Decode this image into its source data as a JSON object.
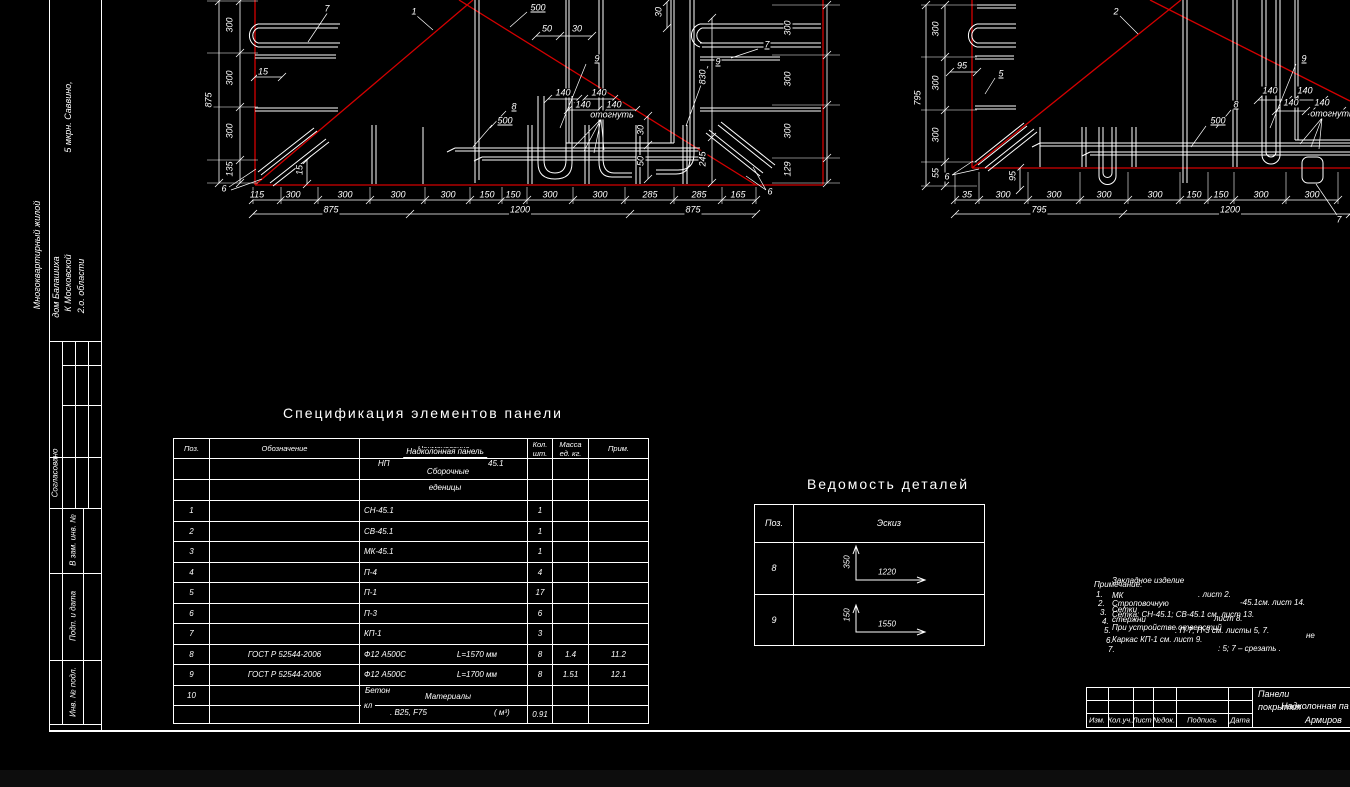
{
  "colors": {
    "background": "#000000",
    "line": "#ffffff",
    "red": "#d40000",
    "offsheet": "#0d0d0d"
  },
  "side_stamp": {
    "project_lines": [
      "Многоквартирный жилой",
      "дом Балашиха",
      "К   Московской",
      "2.о. области",
      "5 мкрн. Саввино,"
    ],
    "approved": "Согласовано",
    "fields": [
      "В зам. инв. №",
      "Подп. и дата",
      "Инв. № подл."
    ]
  },
  "spec_table": {
    "title": "Спецификация элементов панели",
    "headers": {
      "pos": "Поз.",
      "designation": "Обозначение",
      "name": "Наименование",
      "qty1": "Кол.",
      "qty2": "шт.",
      "mass1": "Масса",
      "mass2": "ед. кг.",
      "note": "Прим."
    },
    "subheader": {
      "group_underline": "Надколонная панель",
      "code": "НП",
      "code_num": "45.1",
      "group2": "Сборочные",
      "group2b": "еденицы"
    },
    "materials": {
      "beton": "Бетон",
      "label": "Материалы",
      "kl": "кл",
      "grade": ". В25, F75",
      "unit": "(  м³)"
    },
    "rows": [
      {
        "pos": "",
        "des": "",
        "name": "",
        "len": "",
        "qty": "",
        "mass": "",
        "note": ""
      },
      {
        "pos": "",
        "des": "",
        "name": "",
        "len": "",
        "qty": "",
        "mass": "",
        "note": ""
      },
      {
        "pos": "1",
        "des": "",
        "name": "СН-45.1",
        "len": "",
        "qty": "1",
        "mass": "",
        "note": ""
      },
      {
        "pos": "2",
        "des": "",
        "name": "СВ-45.1",
        "len": "",
        "qty": "1",
        "mass": "",
        "note": ""
      },
      {
        "pos": "3",
        "des": "",
        "name": "МК-45.1",
        "len": "",
        "qty": "1",
        "mass": "",
        "note": ""
      },
      {
        "pos": "4",
        "des": "",
        "name": "П-4",
        "len": "",
        "qty": "4",
        "mass": "",
        "note": ""
      },
      {
        "pos": "5",
        "des": "",
        "name": "П-1",
        "len": "",
        "qty": "17",
        "mass": "",
        "note": ""
      },
      {
        "pos": "6",
        "des": "",
        "name": "П-3",
        "len": "",
        "qty": "6",
        "mass": "",
        "note": ""
      },
      {
        "pos": "7",
        "des": "",
        "name": "КП-1",
        "len": "",
        "qty": "3",
        "mass": "",
        "note": ""
      },
      {
        "pos": "8",
        "des": "ГОСТ Р 52544-2006",
        "name": "Ф12 А500С",
        "len": "L=1570 мм",
        "qty": "8",
        "mass": "1.4",
        "note": "11.2"
      },
      {
        "pos": "9",
        "des": "ГОСТ Р 52544-2006",
        "name": "Ф12 А500С",
        "len": "L=1700 мм",
        "qty": "8",
        "mass": "1.51",
        "note": "12.1"
      },
      {
        "pos": "10",
        "des": "",
        "name": "",
        "len": "",
        "qty": "",
        "mass": "",
        "note": ""
      },
      {
        "pos": "",
        "des": "",
        "name": "",
        "len": "",
        "qty": "0.91",
        "mass": "",
        "note": ""
      }
    ]
  },
  "details_table": {
    "title": "Ведомость деталей",
    "headers": {
      "pos": "Поз.",
      "sketch": "Эскиз"
    },
    "rows": [
      {
        "pos": "8",
        "v": "350",
        "h": "1220"
      },
      {
        "pos": "9",
        "v": "150",
        "h": "1550"
      }
    ]
  },
  "notes": {
    "items": [
      {
        "t": "Закладное изделие",
        "x": 1112,
        "y": 581,
        "al": "l",
        "cls": "note"
      },
      {
        "t": "Примечание:",
        "x": 1094,
        "y": 585,
        "al": "l",
        "cls": "note"
      },
      {
        "t": "1.",
        "x": 1096,
        "y": 595,
        "al": "l",
        "cls": "note"
      },
      {
        "t": "МК",
        "x": 1112,
        "y": 596,
        "al": "l",
        "cls": "note"
      },
      {
        "t": ". лист 2.",
        "x": 1198,
        "y": 595,
        "al": "l",
        "cls": "note"
      },
      {
        "t": "2.",
        "x": 1098,
        "y": 604,
        "al": "l",
        "cls": "note"
      },
      {
        "t": "Строповочную",
        "x": 1112,
        "y": 604,
        "al": "l",
        "cls": "note"
      },
      {
        "t": "-45.1см. лист 14.",
        "x": 1240,
        "y": 603,
        "al": "l",
        "cls": "note"
      },
      {
        "t": "3.",
        "x": 1100,
        "y": 613,
        "al": "l",
        "cls": "note"
      },
      {
        "t": "Сетки",
        "x": 1112,
        "y": 610,
        "al": "l",
        "cls": "note"
      },
      {
        "t": "Сетка: СН-45.1; СВ-45.1 см. лист 13.",
        "x": 1112,
        "y": 615,
        "al": "l",
        "cls": "note"
      },
      {
        "t": "4.",
        "x": 1102,
        "y": 622,
        "al": "l",
        "cls": "note"
      },
      {
        "t": "стержни",
        "x": 1112,
        "y": 620,
        "al": "l",
        "cls": "note"
      },
      {
        "t": "лист 8.",
        "x": 1214,
        "y": 619,
        "al": "l",
        "cls": "note"
      },
      {
        "t": "5.",
        "x": 1104,
        "y": 631,
        "al": "l",
        "cls": "note"
      },
      {
        "t": "При устройстве отверстий",
        "x": 1112,
        "y": 628,
        "al": "l",
        "cls": "note"
      },
      {
        "t": ": П-7; П-3 см. листы 5, 7.",
        "x": 1175,
        "y": 631,
        "al": "l",
        "cls": "note"
      },
      {
        "t": "6.",
        "x": 1106,
        "y": 641,
        "al": "l",
        "cls": "note"
      },
      {
        "t": "Каркас КП-1 см. лист 9.",
        "x": 1112,
        "y": 640,
        "al": "l",
        "cls": "note"
      },
      {
        "t": "не",
        "x": 1306,
        "y": 636,
        "al": "l",
        "cls": "note"
      },
      {
        "t": "7.",
        "x": 1108,
        "y": 650,
        "al": "l",
        "cls": "note"
      },
      {
        "t": ": 5; 7  –  срезать     .",
        "x": 1218,
        "y": 649,
        "al": "l",
        "cls": "note"
      }
    ]
  },
  "title_block": {
    "cols": [
      "Изм.",
      "Кол.уч.",
      "Лист",
      "№док.",
      "Подпись",
      "Дата"
    ],
    "doc_line1": "Панели",
    "doc_line2": "покрытия",
    "doc_line2_overlay": "Надколонная па",
    "doc_line3": "Армиров"
  },
  "drawings": {
    "a_labels": [
      {
        "t": "7",
        "x": 327,
        "y": 9
      },
      {
        "t": "1",
        "x": 414,
        "y": 12
      },
      {
        "t": "500",
        "x": 538,
        "y": 8,
        "u": 1
      },
      {
        "t": "30",
        "x": 659,
        "y": 12,
        "r": -90
      },
      {
        "t": "50",
        "x": 547,
        "y": 29
      },
      {
        "t": "30",
        "x": 577,
        "y": 29
      },
      {
        "t": "9",
        "x": 597,
        "y": 59,
        "u": 1
      },
      {
        "t": "9",
        "x": 718,
        "y": 62,
        "u": 1
      },
      {
        "t": "7",
        "x": 767,
        "y": 45,
        "u": 1
      },
      {
        "t": "15",
        "x": 263,
        "y": 72
      },
      {
        "t": "875",
        "x": 209,
        "y": 100,
        "r": -90
      },
      {
        "t": "300",
        "x": 230,
        "y": 25,
        "r": -90
      },
      {
        "t": "300",
        "x": 230,
        "y": 78,
        "r": -90
      },
      {
        "t": "300",
        "x": 230,
        "y": 131,
        "r": -90
      },
      {
        "t": "135",
        "x": 230,
        "y": 169,
        "r": -90
      },
      {
        "t": "830",
        "x": 703,
        "y": 77,
        "r": -90
      },
      {
        "t": "245",
        "x": 703,
        "y": 159,
        "r": -90
      },
      {
        "t": "30",
        "x": 641,
        "y": 130,
        "r": -90
      },
      {
        "t": "50",
        "x": 641,
        "y": 161,
        "r": -90
      },
      {
        "t": "300",
        "x": 788,
        "y": 28,
        "r": -90
      },
      {
        "t": "300",
        "x": 788,
        "y": 79,
        "r": -90
      },
      {
        "t": "300",
        "x": 788,
        "y": 131,
        "r": -90
      },
      {
        "t": "129",
        "x": 788,
        "y": 169,
        "r": -90
      },
      {
        "t": "140",
        "x": 563,
        "y": 93
      },
      {
        "t": "140",
        "x": 599,
        "y": 93
      },
      {
        "t": "140",
        "x": 583,
        "y": 105
      },
      {
        "t": "140",
        "x": 614,
        "y": 105
      },
      {
        "t": "отогнуть",
        "x": 612,
        "y": 115
      },
      {
        "t": "8",
        "x": 514,
        "y": 107,
        "u": 1
      },
      {
        "t": "500",
        "x": 505,
        "y": 121,
        "u": 1
      },
      {
        "t": "15",
        "x": 300,
        "y": 170,
        "r": -90
      },
      {
        "t": "6",
        "x": 224,
        "y": 189
      },
      {
        "t": "6",
        "x": 770,
        "y": 192
      },
      {
        "t": "115",
        "x": 257,
        "y": 195
      },
      {
        "t": "300",
        "x": 293,
        "y": 195
      },
      {
        "t": "300",
        "x": 345,
        "y": 195
      },
      {
        "t": "300",
        "x": 398,
        "y": 195
      },
      {
        "t": "300",
        "x": 448,
        "y": 195
      },
      {
        "t": "150",
        "x": 487,
        "y": 195
      },
      {
        "t": "150",
        "x": 513,
        "y": 195
      },
      {
        "t": "300",
        "x": 550,
        "y": 195
      },
      {
        "t": "300",
        "x": 600,
        "y": 195
      },
      {
        "t": "285",
        "x": 650,
        "y": 195
      },
      {
        "t": "285",
        "x": 699,
        "y": 195
      },
      {
        "t": "165",
        "x": 738,
        "y": 195
      },
      {
        "t": "875",
        "x": 331,
        "y": 210
      },
      {
        "t": "1200",
        "x": 520,
        "y": 210
      },
      {
        "t": "875",
        "x": 693,
        "y": 210
      }
    ],
    "b_labels": [
      {
        "t": "2",
        "x": 1116,
        "y": 12
      },
      {
        "t": "5",
        "x": 1001,
        "y": 74,
        "u": 1
      },
      {
        "t": "95",
        "x": 962,
        "y": 66
      },
      {
        "t": "95",
        "x": 1013,
        "y": 176,
        "r": -90
      },
      {
        "t": "6",
        "x": 947,
        "y": 177
      },
      {
        "t": "795",
        "x": 918,
        "y": 98,
        "r": -90
      },
      {
        "t": "300",
        "x": 936,
        "y": 29,
        "r": -90
      },
      {
        "t": "300",
        "x": 936,
        "y": 83,
        "r": -90
      },
      {
        "t": "300",
        "x": 936,
        "y": 135,
        "r": -90
      },
      {
        "t": "55",
        "x": 936,
        "y": 173,
        "r": -90
      },
      {
        "t": "9",
        "x": 1304,
        "y": 59,
        "u": 1
      },
      {
        "t": "140",
        "x": 1270,
        "y": 91
      },
      {
        "t": "140",
        "x": 1305,
        "y": 91
      },
      {
        "t": "140",
        "x": 1291,
        "y": 103
      },
      {
        "t": "140",
        "x": 1322,
        "y": 103
      },
      {
        "t": "отогнуть",
        "x": 1332,
        "y": 114
      },
      {
        "t": "8",
        "x": 1236,
        "y": 105,
        "u": 1
      },
      {
        "t": "500",
        "x": 1218,
        "y": 121,
        "u": 1
      },
      {
        "t": "7",
        "x": 1339,
        "y": 220
      },
      {
        "t": "35",
        "x": 967,
        "y": 195
      },
      {
        "t": "300",
        "x": 1003,
        "y": 195
      },
      {
        "t": "300",
        "x": 1054,
        "y": 195
      },
      {
        "t": "300",
        "x": 1104,
        "y": 195
      },
      {
        "t": "300",
        "x": 1155,
        "y": 195
      },
      {
        "t": "150",
        "x": 1194,
        "y": 195
      },
      {
        "t": "150",
        "x": 1221,
        "y": 195
      },
      {
        "t": "300",
        "x": 1261,
        "y": 195
      },
      {
        "t": "300",
        "x": 1312,
        "y": 195
      },
      {
        "t": "795",
        "x": 1039,
        "y": 210
      },
      {
        "t": "1200",
        "x": 1230,
        "y": 210
      }
    ]
  }
}
